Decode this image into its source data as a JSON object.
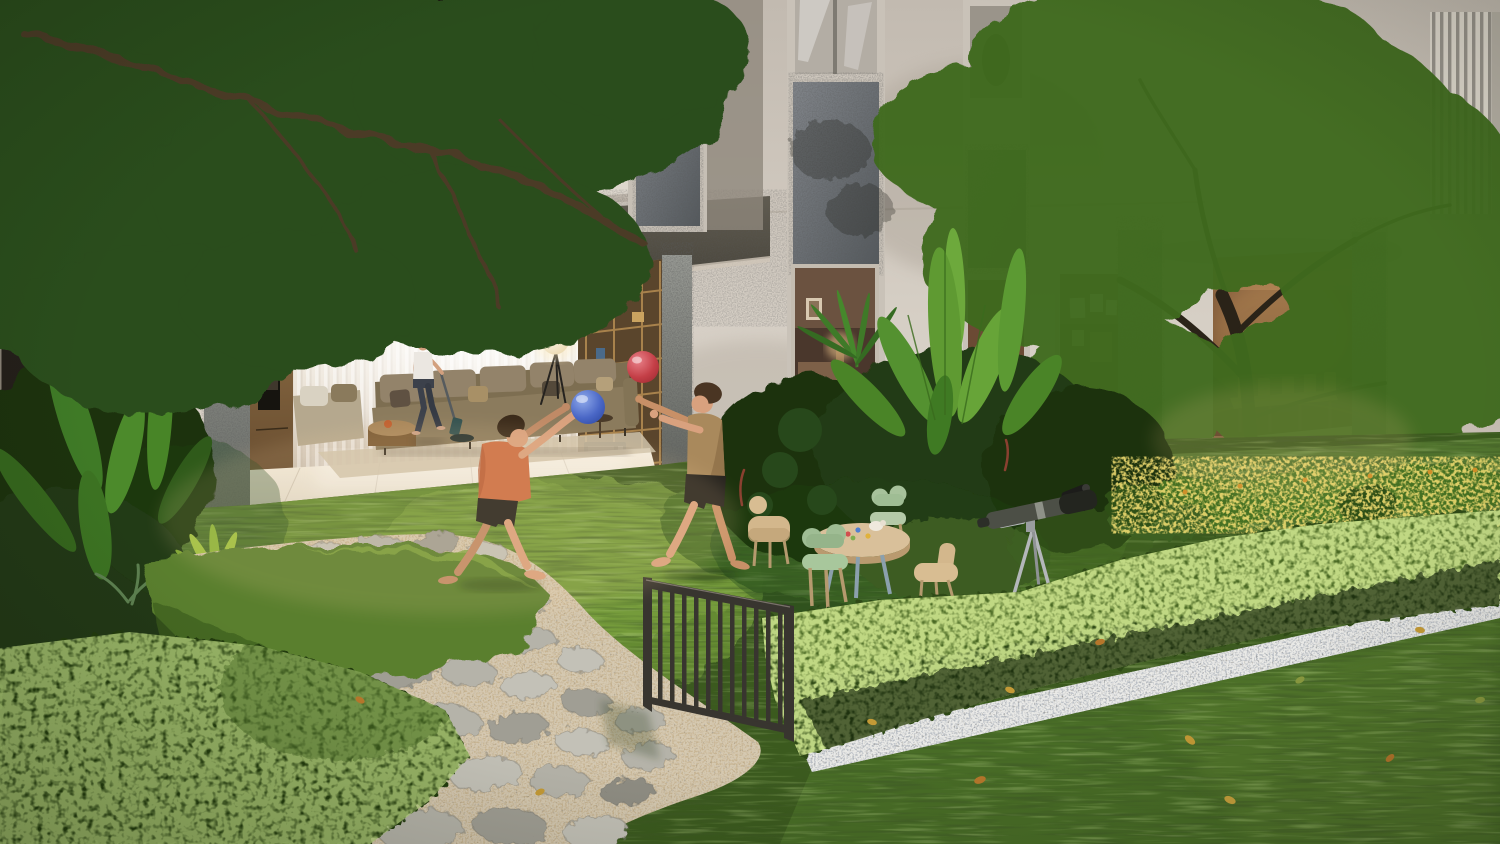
{
  "scene": {
    "description": "Photorealistic dusk rendering of a modern residential courtyard: two boys play with a blue and a red ball on a lawn beside a curving flagstone path, while a woman vacuums the open-plan living room behind a full-height opening; lush tropical planting, a clipped hedge, a kids' play table, a telescope and a small metal fence furnish the garden in front of a beige facade with granite feature panels and a bright green feature tree.",
    "medium": "3d-architectural-render",
    "time_of_day": "late-afternoon"
  },
  "building": {
    "facade_color": "#d3cbc1",
    "granite_beam_color": "#4b463d",
    "stone_panel_color": "#6e7376",
    "balcony_railing": "dark-vertical-slats",
    "louver_screen": "vertical-slat-panel",
    "features": [
      "living-room-opening",
      "dining-room-opening",
      "granite-columns",
      "stone-spandrel-panels",
      "corner-louver-screen"
    ]
  },
  "living_room": {
    "glow_color": "#f8eed9",
    "items": [
      "sheer-curtains",
      "long-olive-sofa",
      "throw-pillows",
      "lounge-chaise",
      "drum-coffee-table",
      "tripod-sphere-floor-lamp",
      "wall-oven-stack",
      "wood-shelving-unit",
      "microwave",
      "beige-rug",
      "glossy-tile-floor"
    ]
  },
  "dining_room": {
    "glow_color": "#c89a5e",
    "items": [
      "wood-dining-table",
      "wood-dining-chairs",
      "light-stone-floor"
    ]
  },
  "windows": [
    {
      "id": "upper-window-sphere-lamp",
      "state": "lit",
      "accent": "#ffedc4"
    },
    {
      "id": "upper-window-reflective",
      "state": "unlit"
    },
    {
      "id": "bedroom-window",
      "state": "lit",
      "accent": "#f3c98e"
    },
    {
      "id": "gallery-window-posters",
      "state": "lit"
    },
    {
      "id": "side-entry-window",
      "state": "lit"
    }
  ],
  "garden": {
    "grass_color": "#4c7026",
    "sunlit_grass_color": "#76a03c",
    "hedge_color": "#2f4a15",
    "hedge_highlight": "#9db544",
    "flagstone_color": "#aeaca2",
    "path_gravel_color": "#c7b593",
    "border_gravel_color": "#b9bec4",
    "elements": [
      "flagstone-path",
      "gravel-border-strip",
      "clipped-hedge-row",
      "corner-hedge-mound",
      "tropical-banana-plants",
      "monstera",
      "palm-fronds",
      "bird-of-paradise",
      "yellow-day-lilies",
      "feature-tree",
      "overhanging-tree-canopy",
      "ground-spotlight",
      "fallen-leaves",
      "metal-bar-fence"
    ]
  },
  "people": [
    {
      "id": "woman-vacuuming",
      "location": "living-room",
      "top_color": "#ebe7e1",
      "pants_color": "#3c414b",
      "activity": "vacuuming"
    },
    {
      "id": "boy-orange-shirt",
      "location": "lawn",
      "shirt_color": "#cc6e44",
      "shorts_color": "#27241f",
      "activity": "catching-blue-ball"
    },
    {
      "id": "boy-tan-shirt",
      "location": "lawn",
      "shirt_color": "#a9895c",
      "shorts_color": "#26231e",
      "activity": "reaching-for-red-ball"
    }
  ],
  "play_objects": {
    "ball_blue": "#3f5fc2",
    "ball_red": "#c43f47",
    "kids_table_color": "#d9c09a",
    "kids_chair_mint": "#a7c29b",
    "kids_chair_tan": "#d3b78c",
    "telescope_body": "#4c4f46",
    "telescope_tripod": "#b4b7ba"
  }
}
